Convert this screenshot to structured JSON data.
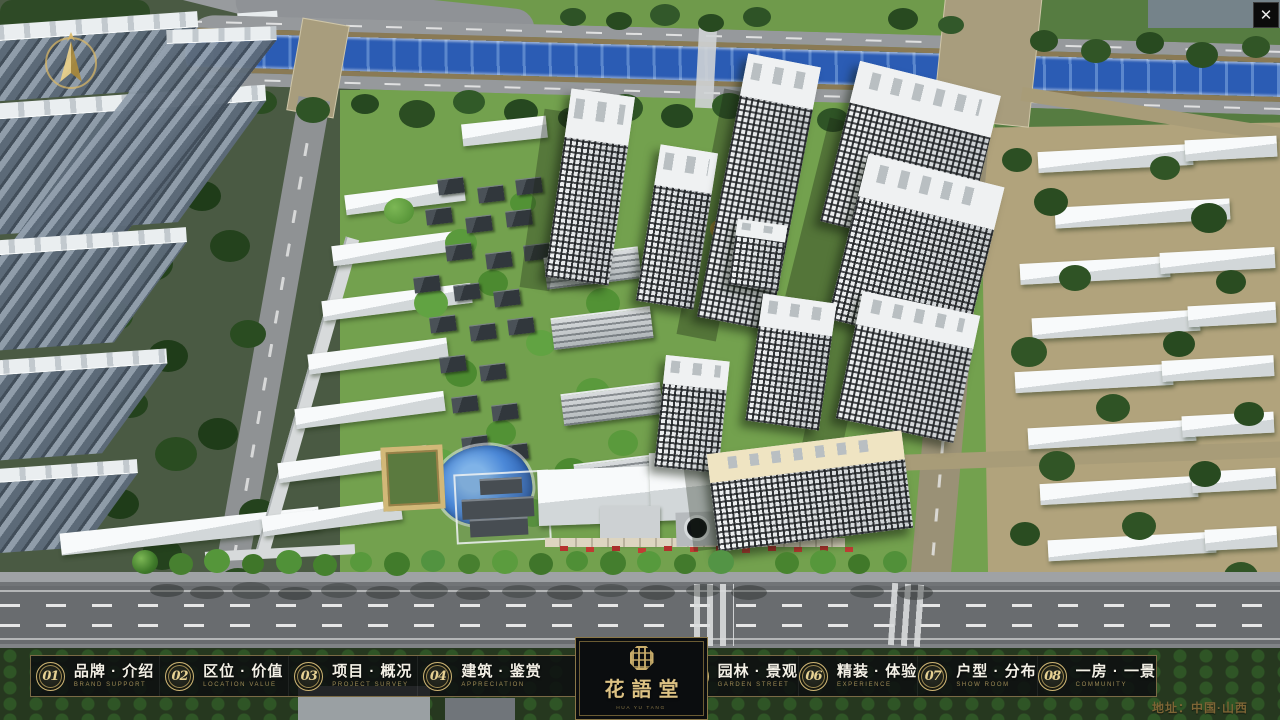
{
  "window": {
    "close_glyph": "✕"
  },
  "menu": {
    "items": [
      {
        "num": "01",
        "label": "品牌 · 介绍",
        "sub": "BRAND SUPPORT"
      },
      {
        "num": "02",
        "label": "区位 · 价值",
        "sub": "LOCATION VALUE"
      },
      {
        "num": "03",
        "label": "项目 · 概况",
        "sub": "PROJECT SURVEY"
      },
      {
        "num": "04",
        "label": "建筑 · 鉴赏",
        "sub": "APPRECIATION"
      },
      {
        "num": "05",
        "label": "园林 · 景观",
        "sub": "GARDEN STREET"
      },
      {
        "num": "06",
        "label": "精装 · 体验",
        "sub": "EXPERIENCE"
      },
      {
        "num": "07",
        "label": "户型 · 分布",
        "sub": "SHOW ROOM"
      },
      {
        "num": "08",
        "label": "一房 · 一景",
        "sub": "COMMUNITY"
      }
    ]
  },
  "logo": {
    "title": "花語堂",
    "caption": "HUA YU TANG"
  },
  "footer": {
    "address": "地址：中国·山西"
  },
  "scene": {
    "colors": {
      "grass": "#6f9a4b",
      "dark-trees": "#2b4d22",
      "river": "#2b5cb4",
      "ground-tan": "#b1a37c",
      "road": "#8f9294",
      "asphalt": "#696c6f",
      "roof-white": "#eef0f2",
      "facade-gray": "#5d6b7a",
      "pool": "#4c89d8",
      "gold": "#c9b06a"
    }
  }
}
